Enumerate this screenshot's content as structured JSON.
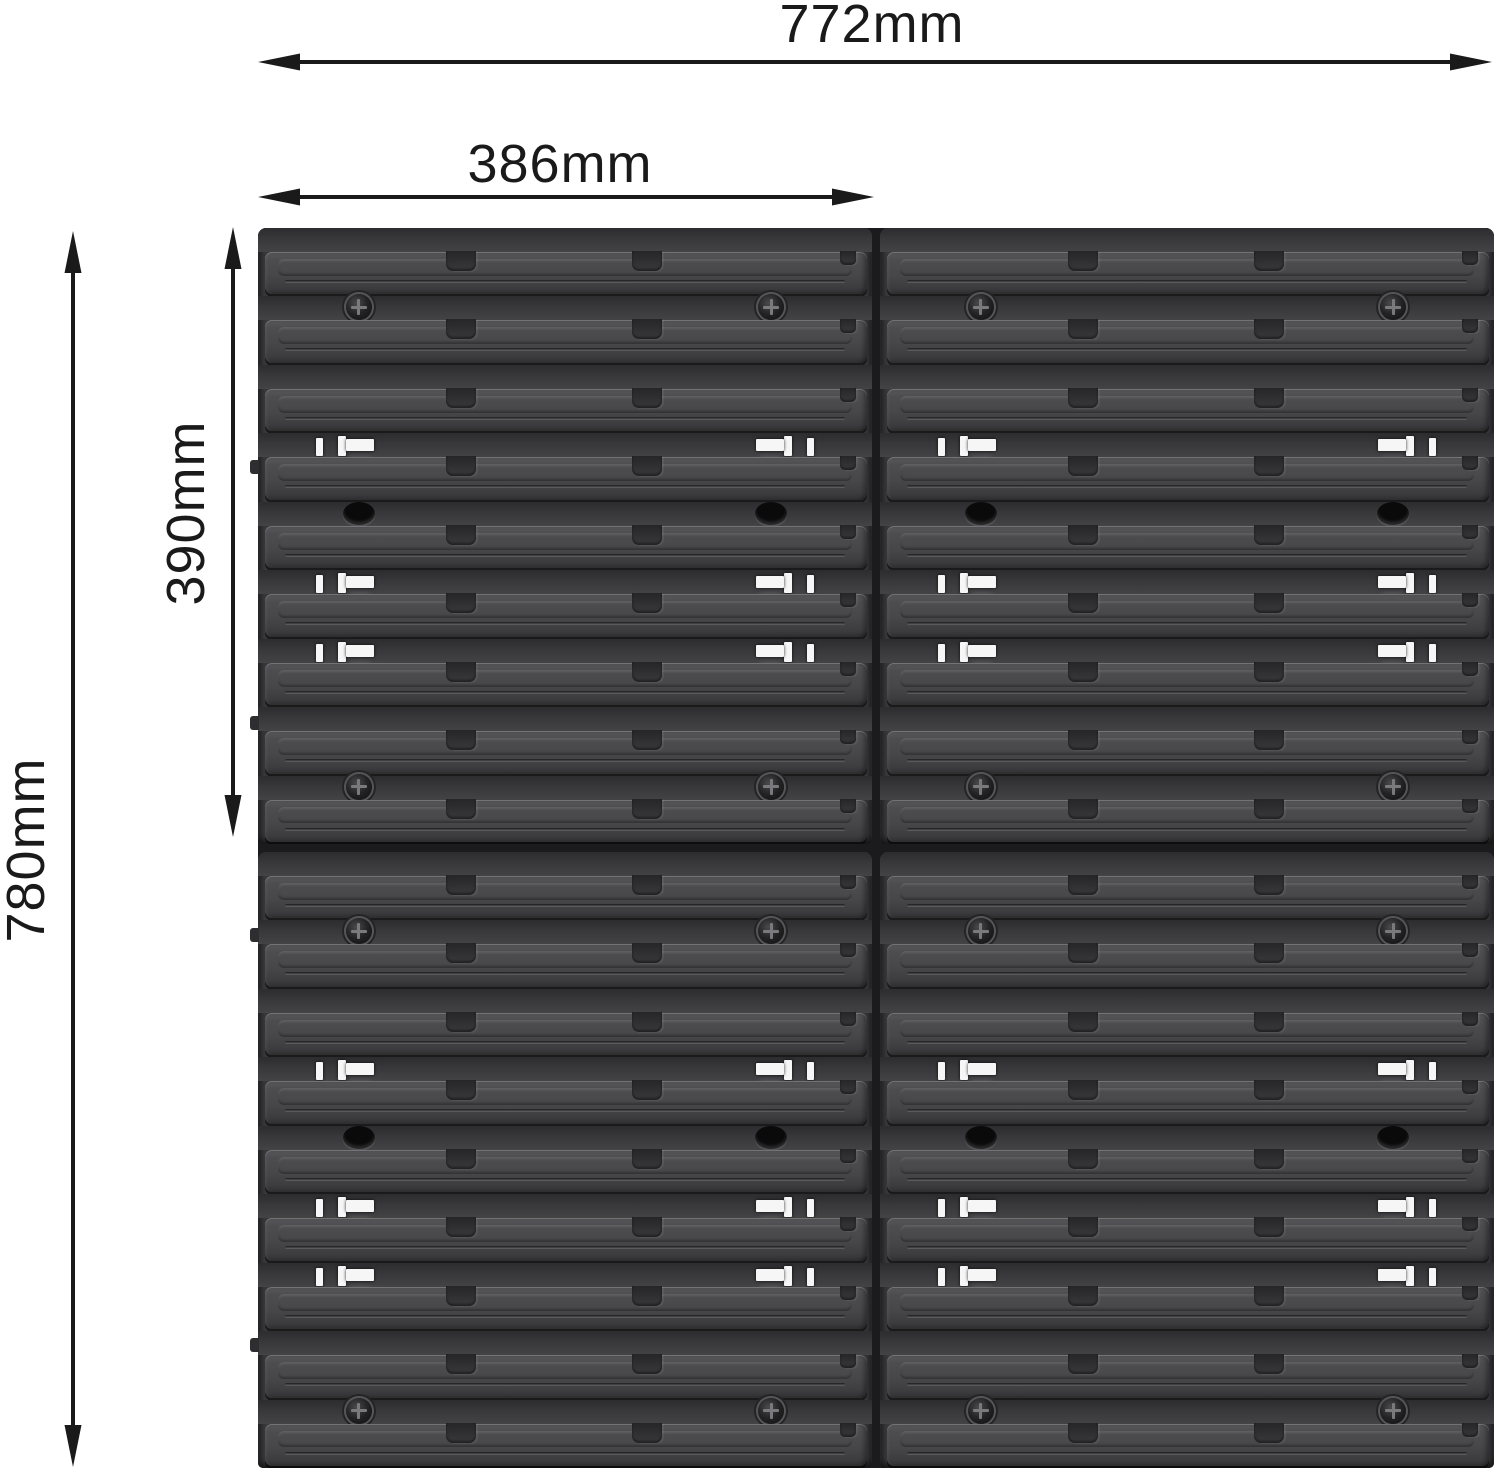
{
  "background_color": "#ffffff",
  "annotation": {
    "color": "#1a1a1a",
    "dimensions": {
      "total_width": {
        "label": "772mm"
      },
      "half_width": {
        "label": "386mm"
      },
      "total_height": {
        "label": "780mm"
      },
      "half_height": {
        "label": "390mm"
      }
    }
  },
  "product": {
    "name": "wall-mounted slatwall storage panel set",
    "panel_grid": {
      "columns": 2,
      "rows": 2
    },
    "slat_rows_per_panel": 9,
    "recess_feature_pattern": [
      "screws",
      "none",
      "slots",
      "ovals",
      "slots",
      "slots",
      "none",
      "screws"
    ],
    "colors": {
      "slat_face": "#47474a",
      "recess": "#3a3a3d",
      "seam": "#1b1b1d",
      "slot_hole": "#f6f6f6",
      "screw": "#0f0f10",
      "oval_hole": "#0a0a0b"
    }
  }
}
